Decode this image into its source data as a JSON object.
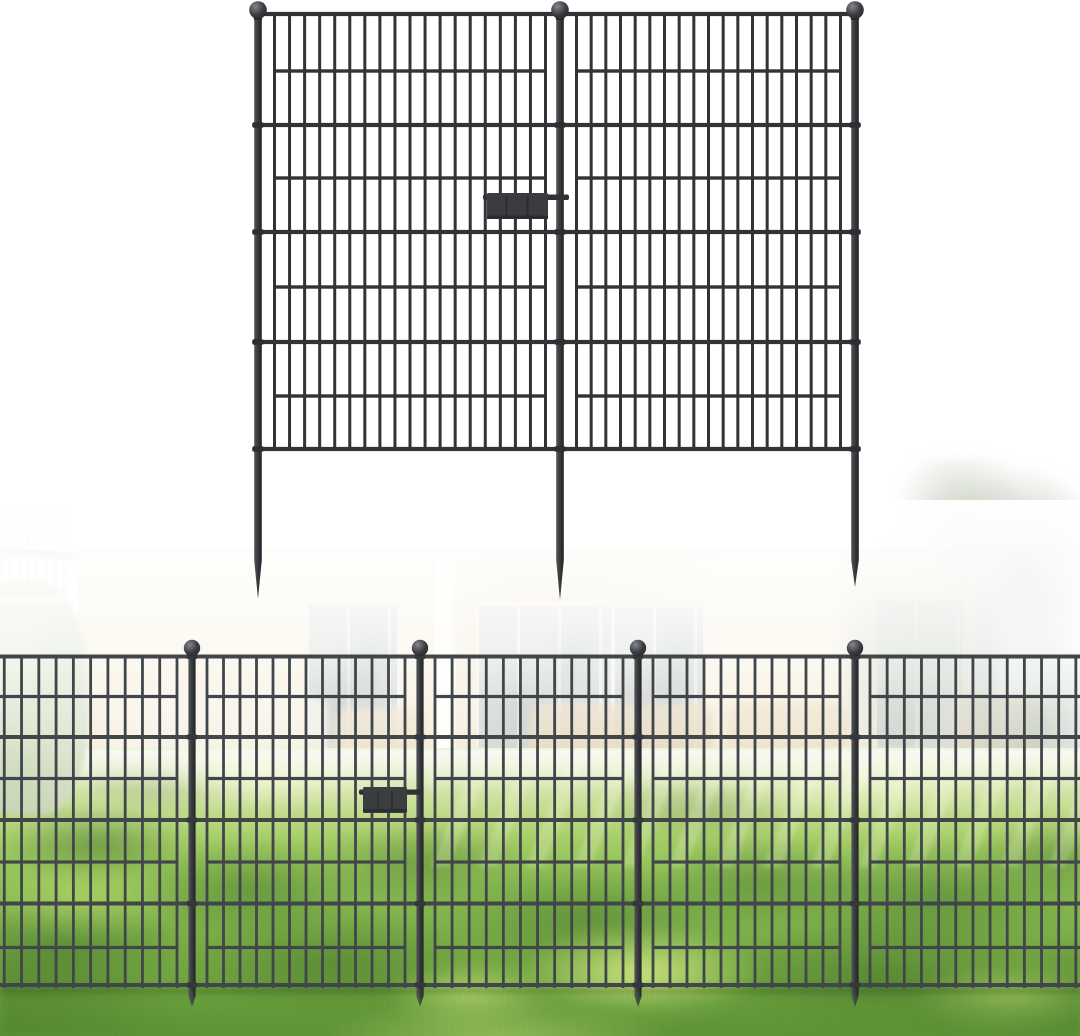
{
  "meta": {
    "type": "product-photo",
    "description": "Black metal no-dig garden fence: two wire-grid panels with ball-top posts and ground spikes shown on white, above a backyard scene with the fence installed along a sunlit lawn in front of a patio house"
  },
  "illustration": {
    "label": "fence-panels-product-view",
    "panel_count": 2,
    "post_count": 3,
    "post_finial": "ball",
    "ground_anchor": "spike-stake",
    "connector": "latch-clip"
  },
  "scene": {
    "label": "installed-fence-backyard-scene",
    "fence_post_count": 4,
    "elements": [
      "house-patio",
      "sliding-glass-doors",
      "porch-column",
      "patio-furniture",
      "hedge",
      "trees",
      "lawn",
      "tree-shadows",
      "installed-fence-row",
      "latch-clip"
    ]
  },
  "colors": {
    "background": "#ffffff",
    "fence_metal": "#323336",
    "fence_metal_scene": "#40464a",
    "house_wall": "#f4e9cf",
    "glass": "#cdd3cc",
    "hedge": "#c4d1ae",
    "trees": "#c2cabc",
    "lawn_light": "#a8cf68",
    "lawn_mid": "#8abc52",
    "lawn_dark": "#6ba03d",
    "shadow_green": "#3a6826",
    "sunlit_grass": "#e0f28e"
  }
}
